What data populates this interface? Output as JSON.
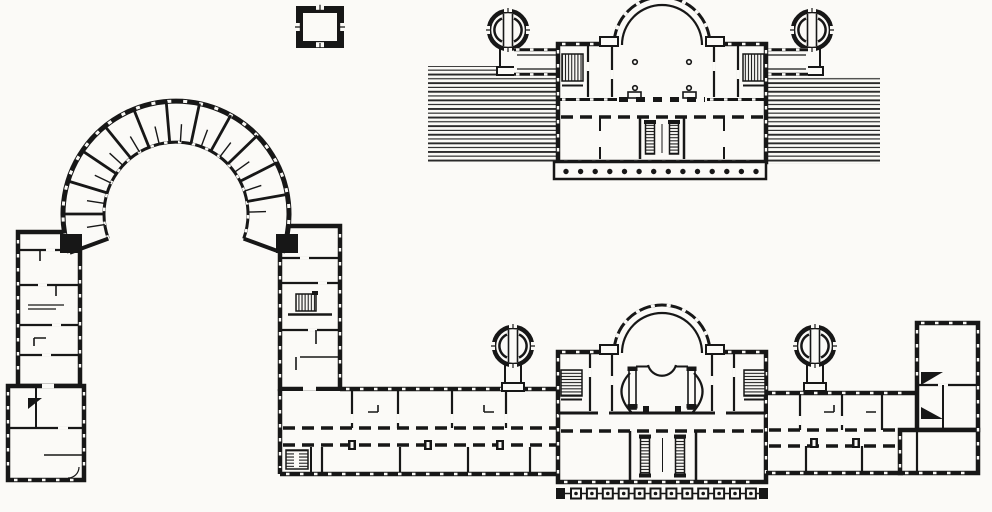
{
  "figure": {
    "type": "scanned architectural floor plan, black ink on paper, no text labels",
    "subject": "palace ensemble: horseshoe corps with triumphal arch, linking corridor wings, apsidal central blocks, round corner pavilions, terraced garden ramps",
    "paper_color": "#fbfaf7",
    "ink_color": "#171717",
    "plans_shown": [
      "small detached square pavilion (top left)",
      "upper garden-front plan with apsidal hall, two round pavilions, hatched terrace ramps and dotted portico (top right)",
      "main plan: horseshoe arch ring with radial rooms, two wings, link wing, central block with semicircular hall and colonnade, east wing and end pavilion (bottom)"
    ]
  },
  "generated": {
    "upper_portico": {
      "count": 14,
      "x0": 566,
      "x1": 756,
      "y": 171.5,
      "r": 2.7
    },
    "colonnade": {
      "count": 12,
      "x0": 571,
      "step": 15.9,
      "y": 488.5,
      "size": 10,
      "dot_r": 1.8
    },
    "arch_radials": {
      "cx": 176,
      "cy": 214,
      "r_inner": 72,
      "r_outer": 113,
      "wall_angles_deg": [
        180,
        163,
        146,
        129,
        112,
        95,
        78,
        61,
        44,
        27,
        10
      ],
      "tick_offset_deg": 8.5,
      "tick_r_outer": 90
    }
  }
}
